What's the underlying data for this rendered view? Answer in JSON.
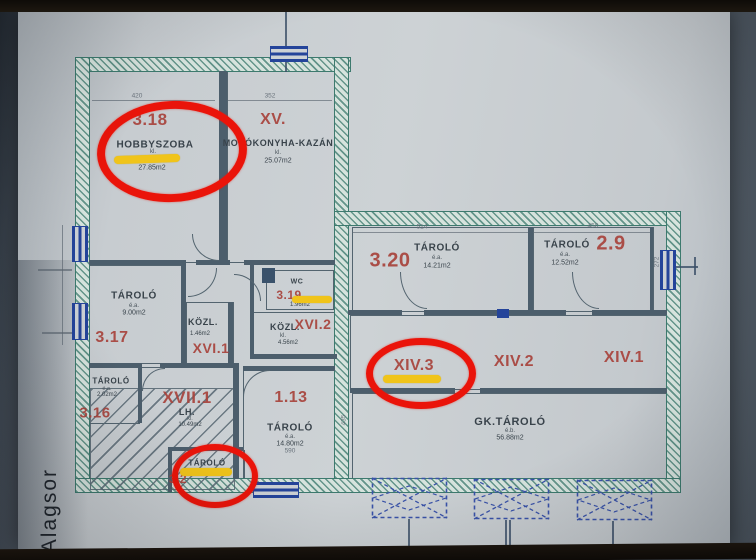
{
  "photo": {
    "surface_label": "Alagsor"
  },
  "colors": {
    "annotation_red": "#ea140a",
    "highlight_yellow": "#f0c41a",
    "room_number_red": "#a8433c",
    "wall_hatch_teal": "#3d7a6e",
    "window_blue": "#24449a",
    "paper": "#c9cdd1"
  },
  "rooms": {
    "hobbyszoba": {
      "number": "3.18",
      "name": "HOBBYSZOBA",
      "sub": "kl.",
      "area": "27.85m2"
    },
    "mosokonyha_kazan": {
      "number": "XV.",
      "name": "MOSÓKONYHA-KAZÁN",
      "sub": "kl.",
      "area": "25.07m2"
    },
    "tarolo_3_20": {
      "number": "3.20",
      "name": "TÁROLÓ",
      "sub": "é.a.",
      "area": "14.21m2"
    },
    "tarolo_2_9": {
      "number": "2.9",
      "name": "TÁROLÓ",
      "sub": "é.a.",
      "area": "12.52m2"
    },
    "tarolo_3_17": {
      "number": "3.17",
      "name": "TÁROLÓ",
      "sub": "é.a.",
      "area": "9.00m2"
    },
    "kozlekedo_xvi_1": {
      "number": "XVI.1",
      "name": "KÖZL.",
      "area": "1.46m2"
    },
    "wc_3_19": {
      "number": "3.19",
      "name": "WC",
      "area": "1.96m2"
    },
    "kozlekedo_xvi_2": {
      "number": "XVI.2",
      "name": "KÖZL.",
      "sub": "kl.",
      "area": "4.56m2"
    },
    "xiv_3": {
      "number": "XIV.3"
    },
    "xiv_2": {
      "number": "XIV.2"
    },
    "xiv_1": {
      "number": "XIV.1"
    },
    "tarolo_3_16": {
      "number": "3.16",
      "name": "TÁROLÓ",
      "sub": "é.a.",
      "area": "2.02m2"
    },
    "lepcsohaz_xvii_1": {
      "number": "XVII.1",
      "name": "LH.",
      "sub": "kl.",
      "area": "10.49m2"
    },
    "tarolo_1_13": {
      "number": "1.13",
      "name": "TÁROLÓ",
      "sub": "é.a.",
      "area": "14.80m2"
    },
    "tarolo_bottom": {
      "number": "3.2",
      "name": "TÁROLÓ"
    },
    "gk_tarolo": {
      "name": "GK.TÁROLÓ",
      "sub": "é.b.",
      "area": "56.88m2"
    }
  },
  "dimensions": {
    "top_left": "420",
    "top_mid": "352",
    "wing_left": "514",
    "wing_right": "450",
    "bottom_1_13": "590",
    "right_side": "272",
    "mid_vert": "435"
  }
}
